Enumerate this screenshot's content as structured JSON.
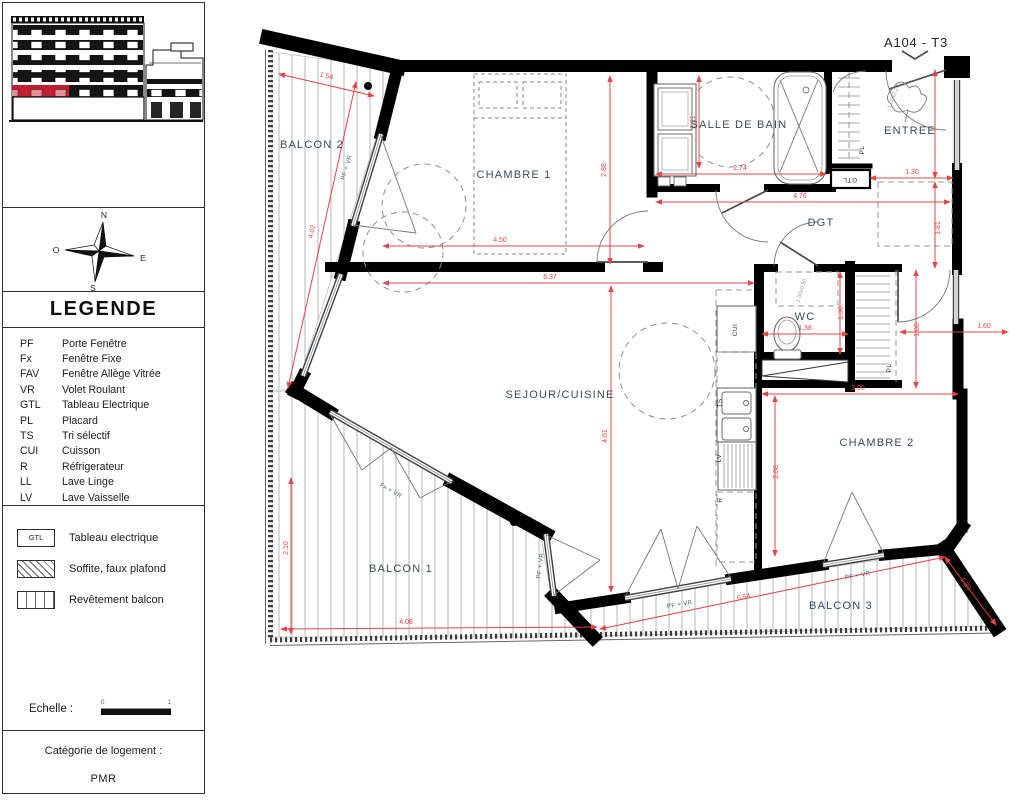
{
  "header": {
    "plan_code": "A104 - T3"
  },
  "sidebar": {
    "compass": {
      "north": "N",
      "south": "S",
      "east": "E",
      "west": "O"
    },
    "legend": {
      "title": "LEGENDE",
      "abbreviations": [
        {
          "abbr": "PF",
          "label": "Porte Fenêtre"
        },
        {
          "abbr": "Fx",
          "label": "Fenêtre Fixe"
        },
        {
          "abbr": "FAV",
          "label": "Fenêtre Allège Vitrée"
        },
        {
          "abbr": "VR",
          "label": "Volet Roulant"
        },
        {
          "abbr": "GTL",
          "label": "Tableau Electrique"
        },
        {
          "abbr": "PL",
          "label": "Placard"
        },
        {
          "abbr": "TS",
          "label": "Tri sélectif"
        },
        {
          "abbr": "CUI",
          "label": "Cuisson"
        },
        {
          "abbr": "R",
          "label": "Réfrigerateur"
        },
        {
          "abbr": "LL",
          "label": "Lave Linge"
        },
        {
          "abbr": "LV",
          "label": "Lave Vaisselle"
        }
      ]
    },
    "symbols": [
      {
        "key": "GTL",
        "label": "Tableau electrique"
      },
      {
        "key": "soffit-hatch",
        "label": "Soffite, faux plafond"
      },
      {
        "key": "balcony-lines",
        "label": "Revêtement balcon"
      }
    ],
    "scale": {
      "label": "Echelle :",
      "tick_start": "0",
      "tick_end": "1"
    },
    "category": {
      "label": "Catégorie de logement :",
      "value": "PMR"
    }
  },
  "plan": {
    "rooms": {
      "balcon2": "BALCON 2",
      "chambre1": "CHAMBRE 1",
      "salle_de_bain": "SALLE DE BAIN",
      "entree": "ENTREE",
      "dgt": "DGT",
      "wc": "WC",
      "sejour": "SEJOUR/CUISINE",
      "chambre2": "CHAMBRE 2",
      "balcon1": "BALCON 1",
      "balcon3": "BALCON 3"
    },
    "fixtures": {
      "gtl": "GTL",
      "pl": "PL",
      "cui": "CUI",
      "ts": "TS",
      "lv": "LV",
      "r": "R"
    },
    "window_labels": {
      "pf_vr": "PF + VR",
      "fx_vr": "Fx + VR"
    },
    "door_sizes": {
      "entry": "1.20x2.20",
      "wc_window": "1.30x0.80"
    },
    "dimensions": {
      "balcon2_top": "1.54",
      "balcon2_diag": "4.02",
      "chambre1_w": "4.50",
      "chambre1_h": "2.88",
      "sejour_w": "6.37",
      "sejour_h": "4.61",
      "sdb_w": "2.74",
      "sdb_h": "2.21",
      "dgt_w": "4.76",
      "entree_w": "1.30",
      "dgt_h": "1.81",
      "wc_w": "1.38",
      "wc_h": "1.30",
      "nook_w": "1.60",
      "nook_h": "1.80",
      "chambre2_w": "3.00",
      "chambre2_h": "2.88",
      "balcon1_h": "2.10",
      "balcon1_w": "4.08",
      "balcon3_w": "6.54",
      "balcon3_h": "1.30"
    },
    "colors": {
      "dimension_red": "#e64545",
      "wall_black": "#000000",
      "elevation_highlight": "#c01f2f",
      "room_label": "#3d4a57"
    }
  }
}
